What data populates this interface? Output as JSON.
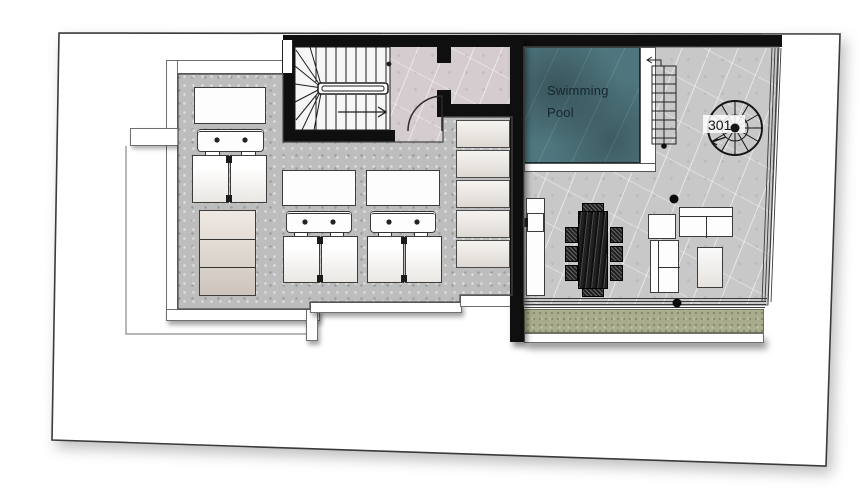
{
  "plan": {
    "labels": {
      "pool": "Swimming Pool",
      "spiral_stair": "301"
    },
    "colors": {
      "wall": "#0f0f0f",
      "pool_water": "#4f767e",
      "deck_concrete": "#bdbdbd",
      "terrace_marble": "#c8c8c8",
      "hallway_marble": "#d4cccf",
      "stair_floor": "#f6f6f6",
      "grass": "#a9ac8d",
      "furniture_white": "#ffffff",
      "boundary_line": "#3a3a3a"
    }
  }
}
